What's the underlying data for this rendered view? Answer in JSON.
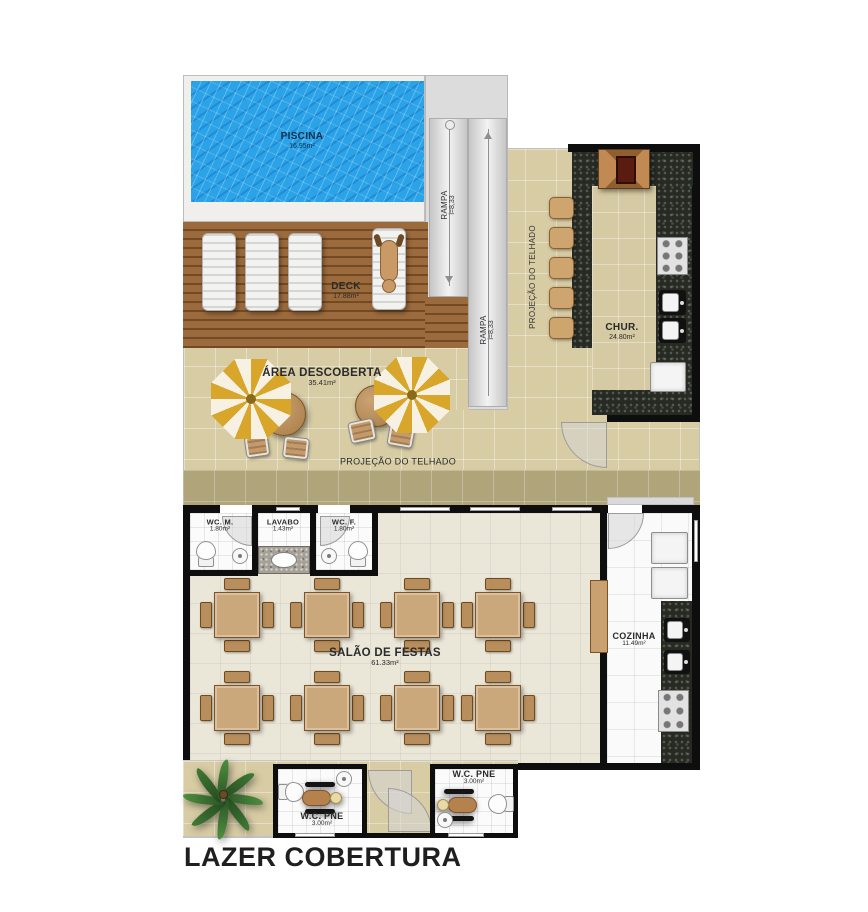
{
  "title": "LAZER COBERTURA",
  "rooms": {
    "piscina": {
      "name": "PISCINA",
      "area": "16.95m²"
    },
    "deck": {
      "name": "DECK",
      "area": "17.88m²"
    },
    "rampa": {
      "name": "RAMPA",
      "slope": "i=8,33"
    },
    "projecao": {
      "name": "PROJEÇÃO DO TELHADO"
    },
    "chur": {
      "name": "CHUR.",
      "area": "24.80m²"
    },
    "area_descoberta": {
      "name": "ÁREA DESCOBERTA",
      "area": "35.41m²"
    },
    "wc_m": {
      "name": "WC. M.",
      "area": "1.80m²"
    },
    "lavabo": {
      "name": "LAVABO",
      "area": "1.43m²"
    },
    "wc_f": {
      "name": "WC. F.",
      "area": "1.80m²"
    },
    "salao": {
      "name": "SALÃO DE FESTAS",
      "area": "61.33m²"
    },
    "cozinha": {
      "name": "COZINHA",
      "area": "11.49m²"
    },
    "wc_pne": {
      "name": "W.C. PNE",
      "area": "3.00m²"
    }
  },
  "colors": {
    "pool_water": "#2aa3e8",
    "deck_wood": "#8d5c32",
    "terrace_tile": "#d7cca4",
    "roof_band": "#b0a47b",
    "granite": "#262a23",
    "salao_floor": "#eae6d8",
    "kitchen_floor": "#fafafa",
    "umbrella_yellow": "#d8a62b",
    "furniture_wood": "#cba87c",
    "wall": "#0e0e0e"
  }
}
